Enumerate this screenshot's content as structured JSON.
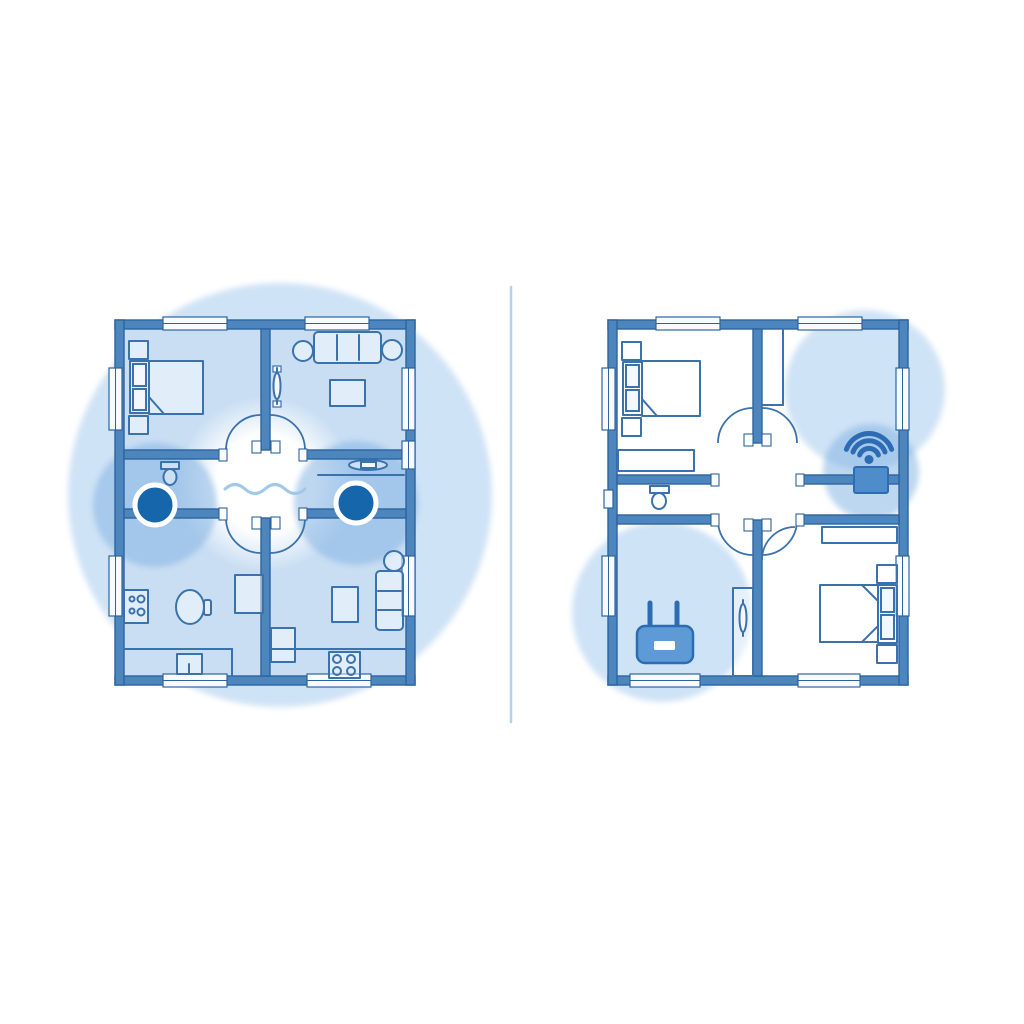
{
  "meta": {
    "kind": "illustration",
    "subject": "wifi-coverage-floorplan-comparison",
    "canvas": {
      "width": 1024,
      "height": 1024
    }
  },
  "colors": {
    "background": "#ffffff",
    "wall": "#4d86bd",
    "wall_outline": "#2e639f",
    "line": "#3a72ae",
    "room_fill": "#c9def3",
    "coverage": "#cfe3f6",
    "coverage_strong": "rgba(125,175,225,0.5)",
    "node": "#1566ab",
    "node_ring": "#ffffff",
    "router_fill": "#5e9bd6",
    "device_fill": "#4e8cca",
    "icon": "#2d6cb3",
    "divider": "#b5d2eb",
    "wave": "#9fc8ea"
  },
  "divider": {
    "x1": 511,
    "y1": 287,
    "x2": 511,
    "y2": 722
  },
  "panels": {
    "left": {
      "label": "floorplan with two mesh wifi nodes and full coverage",
      "coverage_circles": [
        {
          "cx": 280,
          "cy": 495,
          "r": 212
        }
      ],
      "glow": {
        "cx": 265,
        "cy": 484,
        "r": 88
      },
      "node_halos": [
        {
          "cx": 155,
          "cy": 505,
          "r": 62
        },
        {
          "cx": 356,
          "cy": 503,
          "r": 62
        }
      ],
      "mesh_nodes": [
        {
          "cx": 155,
          "cy": 505,
          "r": 20
        },
        {
          "cx": 356,
          "cy": 503,
          "r": 20
        }
      ],
      "rooms": [
        "bedroom",
        "living-room",
        "bathroom-left",
        "bathroom-right",
        "kitchen",
        "lounge"
      ]
    },
    "right": {
      "label": "floorplan with single router and wall extender, partial coverage",
      "coverage_circles": [
        {
          "cx": 865,
          "cy": 390,
          "r": 80
        },
        {
          "cx": 662,
          "cy": 612,
          "r": 90
        }
      ],
      "extender_halo": {
        "cx": 871,
        "cy": 472,
        "r": 48
      },
      "router": {
        "x": 637,
        "y": 626,
        "width": 56,
        "height": 37
      },
      "extender": {
        "x": 854,
        "y": 467,
        "width": 34,
        "height": 26
      },
      "wifi_icon_center": {
        "cx": 869,
        "cy": 459
      },
      "rooms": [
        "bedroom-top",
        "empty-room",
        "bathroom",
        "router-room",
        "bedroom-bottom"
      ]
    }
  }
}
